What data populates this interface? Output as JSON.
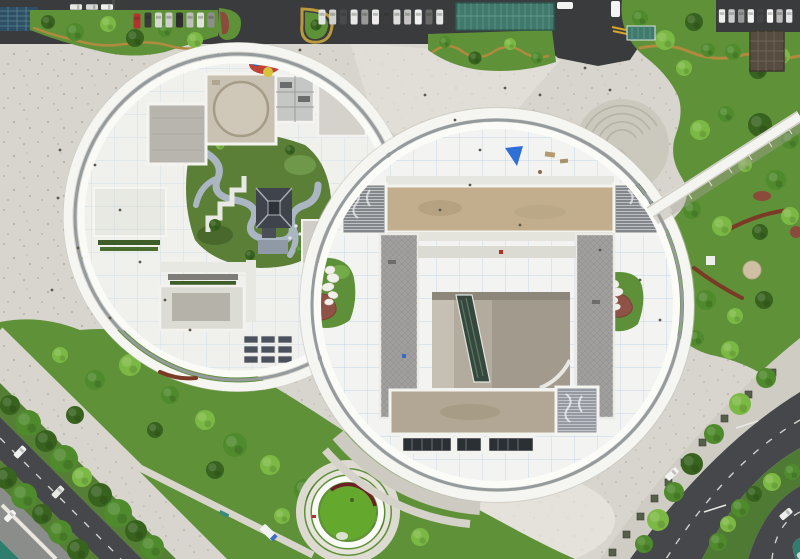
{
  "meta": {
    "title": "Aerial top-down view of a cultural complex: two circular museum buildings with rooftop gardens, plazas, parking lots and tree-lined boulevards"
  },
  "palette": {
    "plaza": "#d7d5cd",
    "plazaLight": "#e8e6df",
    "plazaBright": "#edebe4",
    "plazaDark": "#c9c6bd",
    "asphalt": "#3a3b3d",
    "roadDark": "#45474a",
    "roadLight": "#8b8d8b",
    "roofWhite": "#f0f1ed",
    "ringWhite": "#f5f5f1",
    "ringGray": "#959a9d",
    "gridBlue": "#a9c6e2",
    "blockGray": "#b7b5ad",
    "blockTan": "#c9c2b2",
    "barTan": "#c2ae8d",
    "barTan2": "#b2a794",
    "pierGray": "#a09f9d",
    "louver": "#84878a",
    "pitBase": "#b3ab9e",
    "pitDark": "#a29a8d",
    "escalator": "#36483e",
    "windowDark": "#2b3035",
    "lawn": "#5f9138",
    "lawnLight": "#74ab49",
    "treeDark": "#38631f",
    "treeMid": "#4f8a2d",
    "treeLight": "#7cb944",
    "hedge": "#3d5e28",
    "ochre": "#b08a3e",
    "corten": "#7b3a26",
    "shrubRed": "#8a4a3c",
    "beanRed": "#8e5247",
    "teal": "#3f7a6c",
    "tealLane": "#2f7d6d",
    "panelBlue": "#2f4f66",
    "muralRed": "#bf4438",
    "stoneWhite": "#f2f0ea",
    "pathBlueGray": "#aab7c3",
    "pavilion": "#3f444c",
    "white": "#ffffff",
    "carRed": "#b23230",
    "yellowMark": "#d8a62a",
    "tarpBlue": "#2f6fd6",
    "person": "#5f574b"
  },
  "features": [
    {
      "name": "left-circle-building",
      "label": "Round museum wing with rooftop courtyard garden"
    },
    {
      "name": "rooftop-pavilion",
      "label": "Traditional pavilion in rooftop garden"
    },
    {
      "name": "helipad-roof-block",
      "label": "Roof block with circular helipad marking"
    },
    {
      "name": "right-circle-building",
      "label": "Round exhibition hall with H-shaped roof structure"
    },
    {
      "name": "central-atrium",
      "label": "Open atrium with escalator"
    },
    {
      "name": "stone-stack-sculpture",
      "label": "Stacked stone sculptures in roof gardens"
    },
    {
      "name": "amphitheater",
      "label": "Sunken semicircular amphitheater"
    },
    {
      "name": "pedestrian-bridge",
      "label": "Diagonal white footbridge"
    },
    {
      "name": "sunken-garden",
      "label": "Circular sunken lawn garden"
    },
    {
      "name": "parking-strip",
      "label": "Parking lot with rows of cars"
    },
    {
      "name": "bike-canopy",
      "label": "Teal bicycle shelter canopy"
    },
    {
      "name": "pergola",
      "label": "Dark square pergola on lawn"
    },
    {
      "name": "boulevards",
      "label": "Tree-lined boulevards with bike lanes"
    },
    {
      "name": "crosswalk",
      "label": "Zebra crosswalk at lower left"
    },
    {
      "name": "plaza",
      "label": "Speckled concrete plaza"
    }
  ]
}
